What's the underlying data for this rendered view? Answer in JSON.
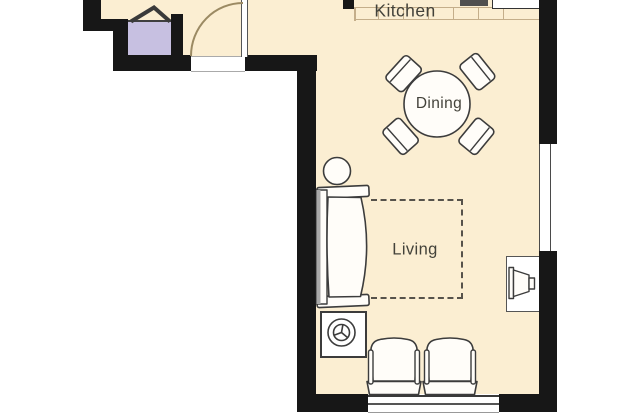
{
  "rooms": {
    "kitchen": {
      "label": "Kitchen"
    },
    "dining": {
      "label": "Dining"
    },
    "living": {
      "label": "Living"
    }
  },
  "colors": {
    "floor": "#fbeed2",
    "wall": "#171717",
    "fixture_purple": "#c7c0e1",
    "counter_line": "#c4ae8a",
    "outline": "#3c3c3c",
    "door_arc": "#9b8a63",
    "dash": "#56524b",
    "shade": "#a8a8a8",
    "appliance_dark": "#4f4f4f",
    "window_line": "#4a4a4a",
    "text": "#43423a"
  },
  "elements": {
    "entry_door": "door-swing-icon",
    "basin": "purple-basin-with-faucet-chevron",
    "counter": "kitchen-counter-grid",
    "cooktop": "dark-appliance",
    "refrigerator": "white-appliance",
    "dining_table": "round-table-4-chairs",
    "side_table": "small-circle-table",
    "sofa": "three-seat-sofa",
    "rug": "dashed-rectangle",
    "washer": "drum-symbol-square",
    "armchairs": "two-armchairs",
    "tv": "crt-tv-on-stand",
    "windows": "double-line-window"
  }
}
